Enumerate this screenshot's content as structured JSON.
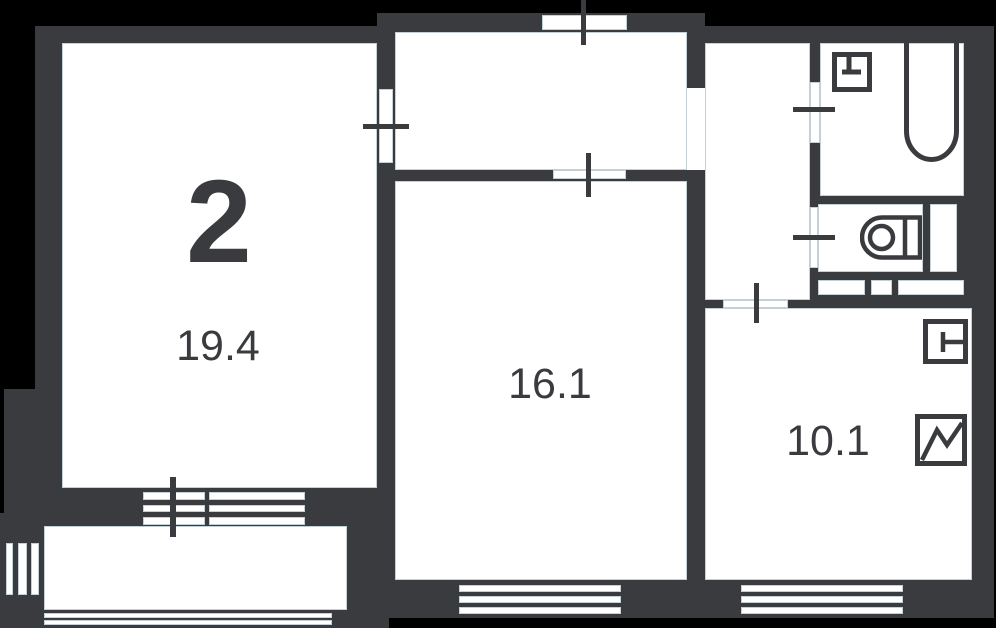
{
  "plan": {
    "rooms_badge": "2",
    "rooms": [
      {
        "name": "living-room",
        "area": "19.4"
      },
      {
        "name": "bedroom",
        "area": "16.1"
      },
      {
        "name": "kitchen",
        "area": "10.1"
      }
    ],
    "colors": {
      "background": "#000000",
      "wall": "#3a3b3f",
      "room_fill": "#ffffff",
      "edge_tint": "#b9c8ce"
    },
    "icons": [
      "sink-icon",
      "bathtub-icon",
      "toilet-icon",
      "appliance-icon",
      "fridge-icon"
    ]
  }
}
